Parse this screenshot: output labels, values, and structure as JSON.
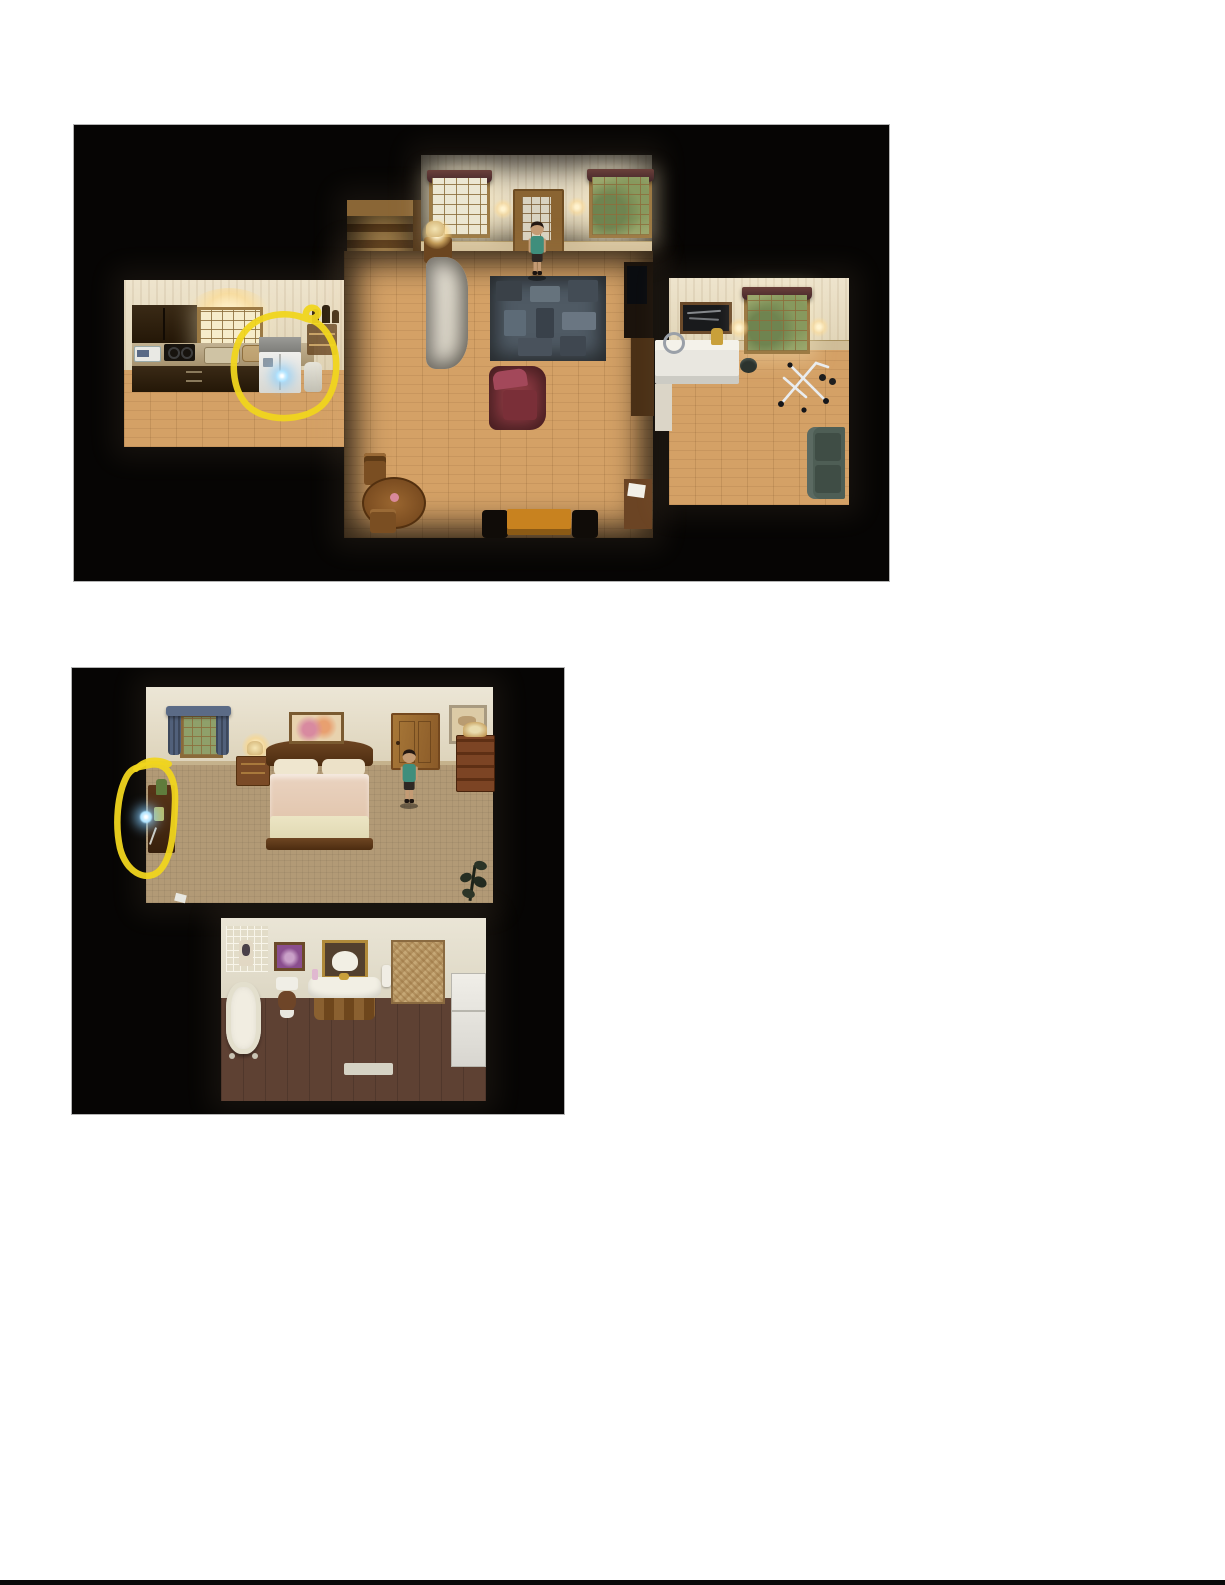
{
  "page": {
    "background": "#ffffff",
    "image_border": "#b4b4b4",
    "footer_bar": "#0a0a0a"
  },
  "annotation": {
    "color": "#f0d51e",
    "style": "hand-drawn circle"
  },
  "sparkle": {
    "color": "#9adcff"
  },
  "characters": {
    "shirt": "#3f8e7c",
    "skin": "#c49b74",
    "hair": "#241812",
    "shorts": "#2e2824"
  },
  "shot1": {
    "name": "first floor - kitchen, stairs, hallway, living room, workout room",
    "background": "#060504",
    "highlight_target": "refrigerator",
    "colors": {
      "wood_floor": "#d4a166",
      "rug": "#4f5a64",
      "armchair": "#8c3a42",
      "stairs": "#6f4b20",
      "orange_table": "#c8821f",
      "couch_green": "#4e5e55",
      "cabinets": "#2e1f10",
      "white_sofa": "#e9e5da",
      "desk_white": "#e9e7e0"
    }
  },
  "shot2": {
    "name": "second floor - bedroom and bathroom",
    "background": "#060504",
    "highlight_target": "shelf with glowing item",
    "colors": {
      "carpet": "#b29a76",
      "bath_floor": "#5e4133",
      "curtain": "#51607a",
      "blanket": "#e6cdbb",
      "bed_wood": "#5a381c",
      "dresser": "#6e3c1e"
    }
  }
}
